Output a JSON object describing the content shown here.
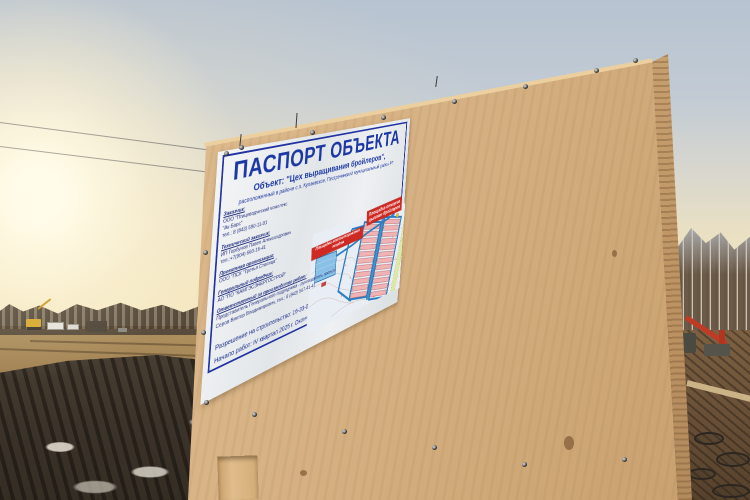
{
  "sign": {
    "title": "ПАСПОРТ ОБЪЕКТА",
    "object_line": "Объект: \"Цех выращивания бройлеров\",",
    "location_line": "расположенный в районе с.п. Кулаевское, Пестречинский муниципальный район РТ",
    "sections": [
      {
        "header": "Заказчик:",
        "lines": [
          "ООО \"Птицеводческий комплекс",
          "\"Ак Барс\"",
          "тел.: 8 (843) 590-11-01"
        ]
      },
      {
        "header": "Технический заказчик:",
        "lines": [
          "ИП Горбунов Павел Александрович",
          "тел.:+7(904) 660-16-41"
        ]
      },
      {
        "header": "Проектная организация:",
        "lines": [
          "ООО \"ПСК \"Третья Столица\""
        ]
      },
      {
        "header": "Генеральный подрядчик:",
        "lines": [
          "АО \"ПО \"КАМГЭСЭНЕРГОСТРОЙ\""
        ]
      },
      {
        "header": "Ответственный за производство работ:",
        "lines": [
          "Представитель Генерального подрядчика - руководитель проекта",
          "Серов Виктор Владимирович, тел.: 8 (843) 567-41-41"
        ]
      }
    ],
    "permit_line": "Разрешение на строительство: 16-33-0056-2025 от 28.07.2025 г.",
    "dates_line": "Начало работ: IV квартал 2025 г. Окончание работ: II квартал 2027 г.",
    "map_labels": {
      "composting": "Площадка компостирования помёта",
      "feeding_line1": "Площадка откорма",
      "feeding_line2": "цыплят бройлеров"
    },
    "colors": {
      "title_blue": "#1c38a4",
      "frame_blue": "#2334a2",
      "label_red": "#ce2a23"
    }
  }
}
